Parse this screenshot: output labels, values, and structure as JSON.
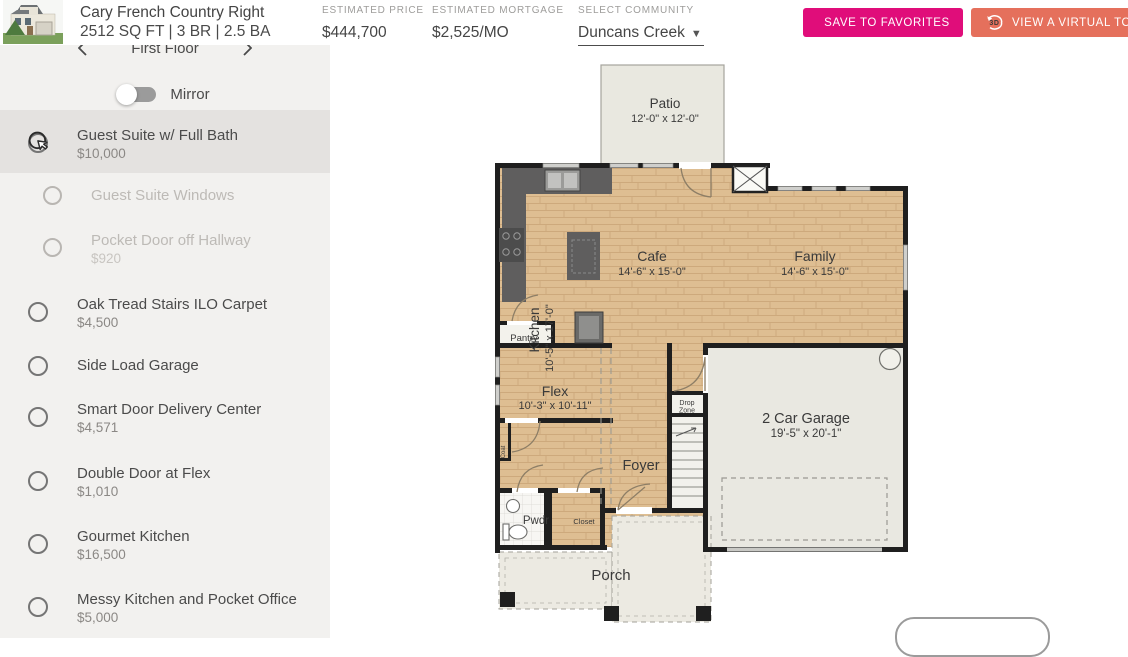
{
  "header": {
    "plan_name": "Cary French Country Right",
    "plan_specs": "2512 SQ FT | 3 BR | 2.5 BA",
    "price_label": "ESTIMATED PRICE",
    "price_value": "$444,700",
    "mortgage_label": "ESTIMATED MORTGAGE",
    "mortgage_value": "$2,525/MO",
    "community_label": "SELECT COMMUNITY",
    "community_value": "Duncans Creek",
    "save_button_label": "SAVE TO FAVORITES",
    "tour_button_label": "VIEW A VIRTUAL TOUR"
  },
  "sidebar": {
    "floor_nav": {
      "label": "First Floor"
    },
    "mirror_label": "Mirror",
    "options": [
      {
        "label": "Guest Suite w/ Full Bath",
        "price": "$10,000",
        "state": "highlighted",
        "indent": false
      },
      {
        "label": "Guest Suite Windows",
        "price": "",
        "state": "disabled",
        "indent": true
      },
      {
        "label": "Pocket Door off Hallway",
        "price": "$920",
        "state": "disabled",
        "indent": true
      },
      {
        "label": "Oak Tread Stairs ILO Carpet",
        "price": "$4,500",
        "state": "normal",
        "indent": false
      },
      {
        "label": "Side Load Garage",
        "price": "",
        "state": "normal",
        "indent": false
      },
      {
        "label": "Smart Door Delivery Center",
        "price": "$4,571",
        "state": "normal",
        "indent": false
      },
      {
        "label": "Double Door at Flex",
        "price": "$1,010",
        "state": "normal",
        "indent": false
      },
      {
        "label": "Gourmet Kitchen",
        "price": "$16,500",
        "state": "normal",
        "indent": false
      },
      {
        "label": "Messy Kitchen and Pocket Office",
        "price": "$5,000",
        "state": "normal",
        "indent": false
      }
    ]
  },
  "floorplan": {
    "rooms": [
      {
        "name": "Patio",
        "dims": "12'-0\" x 12'-0\""
      },
      {
        "name": "Kitchen",
        "dims": "10'-5\" x 17'-0\""
      },
      {
        "name": "Cafe",
        "dims": "14'-6\" x 15'-0\""
      },
      {
        "name": "Family",
        "dims": "14'-6\" x 15'-0\""
      },
      {
        "name": "Pantry"
      },
      {
        "name": "Flex",
        "dims": "10'-3\" x 10'-11\""
      },
      {
        "name": "Drop Zone",
        "lines": [
          "Drop",
          "Zone"
        ]
      },
      {
        "name": "Foyer"
      },
      {
        "name": "2 Car Garage",
        "dims": "19'-5\" x 20'-1\""
      },
      {
        "name": "Pwdr"
      },
      {
        "name": "Closet"
      },
      {
        "name": "Coat"
      },
      {
        "name": "Porch"
      }
    ]
  },
  "colors": {
    "save_button": "#e00d7a",
    "tour_button": "#e5705c",
    "sidebar_bg": "#f2f1ef",
    "selected_row_bg": "#e4e2e0",
    "wood_floor": "#debe92",
    "wall": "#1f1f1f"
  }
}
